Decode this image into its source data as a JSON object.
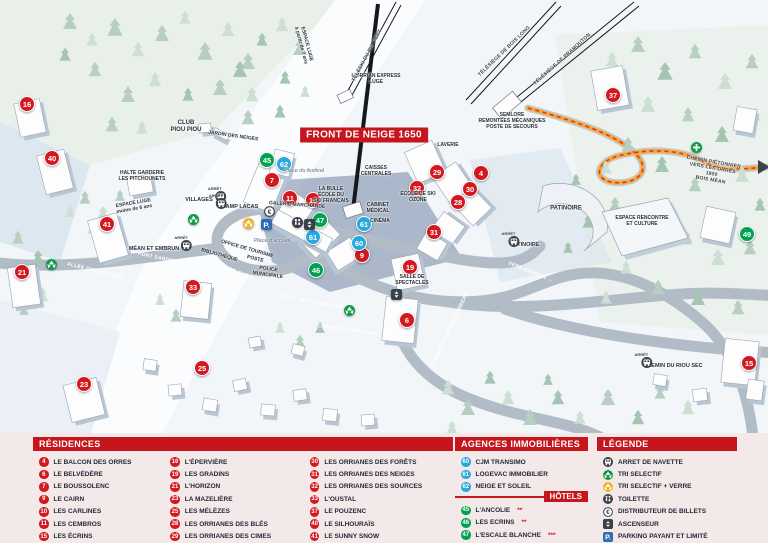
{
  "map": {
    "banner": "FRONT DE NEIGE 1650",
    "markers": [
      {
        "n": "16",
        "t": "res",
        "x": 27,
        "y": 104
      },
      {
        "n": "40",
        "t": "res",
        "x": 52,
        "y": 158
      },
      {
        "n": "41",
        "t": "res",
        "x": 107,
        "y": 224
      },
      {
        "n": "21",
        "t": "res",
        "x": 22,
        "y": 272
      },
      {
        "n": "23",
        "t": "res",
        "x": 84,
        "y": 384
      },
      {
        "n": "25",
        "t": "res",
        "x": 202,
        "y": 368
      },
      {
        "n": "33",
        "t": "res",
        "x": 193,
        "y": 287
      },
      {
        "n": "7",
        "t": "res",
        "x": 272,
        "y": 180
      },
      {
        "n": "11",
        "t": "res",
        "x": 290,
        "y": 198
      },
      {
        "n": "10",
        "t": "res",
        "x": 313,
        "y": 200
      },
      {
        "n": "9",
        "t": "res",
        "x": 362,
        "y": 255
      },
      {
        "n": "29",
        "t": "res",
        "x": 437,
        "y": 172
      },
      {
        "n": "4",
        "t": "res",
        "x": 481,
        "y": 173
      },
      {
        "n": "32",
        "t": "res",
        "x": 417,
        "y": 188
      },
      {
        "n": "30",
        "t": "res",
        "x": 470,
        "y": 189
      },
      {
        "n": "28",
        "t": "res",
        "x": 458,
        "y": 202
      },
      {
        "n": "31",
        "t": "res",
        "x": 434,
        "y": 232
      },
      {
        "n": "19",
        "t": "res",
        "x": 410,
        "y": 267
      },
      {
        "n": "6",
        "t": "res",
        "x": 407,
        "y": 320
      },
      {
        "n": "15",
        "t": "res",
        "x": 749,
        "y": 363
      },
      {
        "n": "37",
        "t": "res",
        "x": 613,
        "y": 95
      },
      {
        "n": "62",
        "t": "ag",
        "x": 284,
        "y": 164
      },
      {
        "n": "61",
        "t": "ag",
        "x": 364,
        "y": 224
      },
      {
        "n": "61",
        "t": "ag",
        "x": 313,
        "y": 237
      },
      {
        "n": "60",
        "t": "ag",
        "x": 359,
        "y": 243
      },
      {
        "n": "45",
        "t": "ho",
        "x": 267,
        "y": 160
      },
      {
        "n": "47",
        "t": "ho",
        "x": 320,
        "y": 220
      },
      {
        "n": "46",
        "t": "ho",
        "x": 316,
        "y": 270
      },
      {
        "n": "49",
        "t": "ho",
        "x": 747,
        "y": 234
      }
    ],
    "labels": [
      {
        "text": "CLUB\nPIOU PIOU",
        "x": 186,
        "y": 127,
        "cls": "fac"
      },
      {
        "text": "JARDIN DES NEIGES",
        "x": 233,
        "y": 137,
        "cls": "facsm",
        "rot": 8
      },
      {
        "text": "HALTE GARDERIE\nLES PITCHOUNETS",
        "x": 142,
        "y": 177,
        "cls": "facsm"
      },
      {
        "text": "ESPACE LUGE\nmoins de 6 ans",
        "x": 134,
        "y": 207,
        "cls": "facsm",
        "rot": -10
      },
      {
        "text": "ESPACE LUGE\nà partir de 7 ans",
        "x": 303,
        "y": 45,
        "cls": "facsm",
        "rot": 75
      },
      {
        "text": "L'ORRIAN EXPRESS\nLUGE",
        "x": 376,
        "y": 80,
        "cls": "facsm"
      },
      {
        "text": "SEMLORE\nREMONTÉES MÉCANIQUES\nPOSTE DE SECOURS",
        "x": 512,
        "y": 122,
        "cls": "facsm"
      },
      {
        "text": "LAVERIE",
        "x": 448,
        "y": 146,
        "cls": "facsm"
      },
      {
        "text": "CAISSES\nCENTRALES",
        "x": 376,
        "y": 172,
        "cls": "facsm"
      },
      {
        "text": "LA BULLE\nÉCOLE DU\nSKI FRANÇAIS",
        "x": 331,
        "y": 196,
        "cls": "facsm"
      },
      {
        "text": "Place du festival",
        "x": 304,
        "y": 171,
        "cls": "place"
      },
      {
        "text": "GALERIE MARCHANDE",
        "x": 297,
        "y": 206,
        "cls": "facsm",
        "rot": 4
      },
      {
        "text": "ÉCOLE DE SKI\nOZONE",
        "x": 418,
        "y": 198,
        "cls": "facsm"
      },
      {
        "text": "CABINET\nMÉDICAL",
        "x": 378,
        "y": 209,
        "cls": "facsm"
      },
      {
        "text": "CINÉMA",
        "x": 380,
        "y": 222,
        "cls": "facsm"
      },
      {
        "text": "OFFICE DE TOURISME",
        "x": 247,
        "y": 250,
        "cls": "facsm",
        "rot": 16
      },
      {
        "text": "BIBLIOTHÈQUE",
        "x": 219,
        "y": 256,
        "cls": "facsm",
        "rot": 16
      },
      {
        "text": "POSTE",
        "x": 255,
        "y": 260,
        "cls": "facsm",
        "rot": 14
      },
      {
        "text": "POLICE\nMUNICIPALE",
        "x": 268,
        "y": 273,
        "cls": "facsm",
        "rot": 8
      },
      {
        "text": "DÉPOSE CARS",
        "x": 233,
        "y": 272,
        "cls": "road",
        "rot": 20
      },
      {
        "text": "Place d'accueil",
        "x": 272,
        "y": 241,
        "cls": "place"
      },
      {
        "text": "PATINOIRE",
        "x": 566,
        "y": 209,
        "cls": "fac"
      },
      {
        "text": "ESPACE RENCONTRE\nET CULTURE",
        "x": 642,
        "y": 222,
        "cls": "facsm"
      },
      {
        "text": "SALLE DE\nSPECTACLES",
        "x": 412,
        "y": 281,
        "cls": "facsm"
      },
      {
        "text": "ALLÉE DES CHAMOIS",
        "x": 95,
        "y": 272,
        "cls": "road",
        "rot": 14
      },
      {
        "text": "PONT SARDINS",
        "x": 158,
        "y": 259,
        "cls": "road",
        "rot": 12
      },
      {
        "text": "ROUTE DE PRAMOUTON",
        "x": 310,
        "y": 303,
        "cls": "road",
        "rot": 10
      },
      {
        "text": "CHEMIN DU MOUFLON",
        "x": 347,
        "y": 331,
        "cls": "road",
        "rot": 8
      },
      {
        "text": "CHEMIN DU GRAND CORBEAU",
        "x": 451,
        "y": 330,
        "cls": "road",
        "rot": -65
      },
      {
        "text": "VERS EMBRUN →",
        "x": 530,
        "y": 273,
        "cls": "road",
        "rot": 22
      },
      {
        "text": "TÉLÉSKI DU PIC VERT",
        "x": 368,
        "y": 56,
        "cls": "lift",
        "rot": -62
      },
      {
        "text": "TÉLÉSIÈGE DE BOIS LONG",
        "x": 505,
        "y": 52,
        "cls": "lift",
        "rot": -44
      },
      {
        "text": "TÉLÉSIÈGE DE PRAMOUTON",
        "x": 563,
        "y": 60,
        "cls": "lift",
        "rot": -42
      },
      {
        "text": "CHEMIN PIÉTONNIER\nVERS LES ORRES 1800\nBOIS MÉAN",
        "x": 712,
        "y": 172,
        "cls": "lift",
        "rot": 10
      }
    ],
    "stops": [
      {
        "caption": "ARRÊT",
        "name": "VILLAGES",
        "x": 200,
        "y": 200,
        "side": "right"
      },
      {
        "caption": "ARRÊT",
        "name": "CHAMP LACAS",
        "x": 237,
        "y": 207,
        "side": "left"
      },
      {
        "caption": "ARRÊT",
        "name": "MÉAN ET EMBRUN",
        "x": 155,
        "y": 249,
        "side": "right"
      },
      {
        "caption": "ARRÊT",
        "name": "PATINOIRE",
        "x": 524,
        "y": 245,
        "side": "left"
      },
      {
        "caption": "ARRÊT",
        "name": "CHEMIN DU RIOU SEC",
        "x": 672,
        "y": 366,
        "side": "left"
      }
    ],
    "icons": [
      {
        "type": "recycle-green",
        "x": 46,
        "y": 268
      },
      {
        "type": "recycle-green",
        "x": 188,
        "y": 223
      },
      {
        "type": "recycle-green",
        "x": 344,
        "y": 314
      },
      {
        "type": "cross-green",
        "x": 691,
        "y": 151
      },
      {
        "type": "recycle-yellow",
        "x": 243,
        "y": 227
      },
      {
        "type": "parking",
        "x": 261,
        "y": 228
      },
      {
        "type": "euro",
        "x": 264,
        "y": 215
      },
      {
        "type": "wc",
        "x": 292,
        "y": 226
      },
      {
        "type": "elevator",
        "x": 304,
        "y": 228
      },
      {
        "type": "elevator",
        "x": 391,
        "y": 298
      }
    ]
  },
  "legend": {
    "residences": {
      "title": "RÉSIDENCES",
      "items": [
        {
          "n": "4",
          "label": "LE BALCON DES ORRES"
        },
        {
          "n": "6",
          "label": "LE BELVÉDÈRE"
        },
        {
          "n": "7",
          "label": "LE BOUSSOLENC"
        },
        {
          "n": "9",
          "label": "LE CAIRN"
        },
        {
          "n": "10",
          "label": "LES CARLINES"
        },
        {
          "n": "11",
          "label": "LES CEMBROS"
        },
        {
          "n": "15",
          "label": "LES ÉCRINS"
        },
        {
          "n": "16",
          "label": "L'ÉPERVIÈRE"
        },
        {
          "n": "19",
          "label": "LES GRADINS"
        },
        {
          "n": "21",
          "label": "L'HORIZON"
        },
        {
          "n": "23",
          "label": "LA MAZELIÈRE"
        },
        {
          "n": "25",
          "label": "LES MÉLÈZES"
        },
        {
          "n": "28",
          "label": "LES ORRIANES DES BLÉS"
        },
        {
          "n": "29",
          "label": "LES ORRIANES DES CIMES"
        },
        {
          "n": "30",
          "label": "LES ORRIANES DES FORÊTS"
        },
        {
          "n": "31",
          "label": "LES ORRIANES DES NEIGES"
        },
        {
          "n": "32",
          "label": "LES ORRIANES DES SOURCES"
        },
        {
          "n": "33",
          "label": "L'OUSTAL"
        },
        {
          "n": "37",
          "label": "LE POUZENC"
        },
        {
          "n": "40",
          "label": "LE SILHOURAÏS"
        },
        {
          "n": "41",
          "label": "LE SUNNY SNOW"
        }
      ]
    },
    "agences": {
      "title": "AGENCES IMMOBILIÈRES",
      "items": [
        {
          "n": "60",
          "label": "CJM TRANSIMO"
        },
        {
          "n": "61",
          "label": "LOGEVAC IMMOBILIER"
        },
        {
          "n": "62",
          "label": "NEIGE ET SOLEIL"
        }
      ]
    },
    "hotels": {
      "title": "HÔTELS",
      "items": [
        {
          "n": "45",
          "label": "L'ANCOLIE",
          "stars": "**"
        },
        {
          "n": "46",
          "label": "LES ECRINS",
          "stars": "**"
        },
        {
          "n": "47",
          "label": "L'ESCALE BLANCHE",
          "stars": "***"
        },
        {
          "n": "49",
          "label": "LES TRAPPEURS",
          "stars": "**"
        }
      ]
    },
    "legende": {
      "title": "LÉGENDE",
      "items": [
        {
          "type": "bus",
          "label": "ARRET DE NAVETTE"
        },
        {
          "type": "recycle-green",
          "label": "TRI SELECTIF"
        },
        {
          "type": "recycle-yellow",
          "label": "TRI SELECTIF + VERRE"
        },
        {
          "type": "wc",
          "label": "TOILETTE"
        },
        {
          "type": "euro",
          "label": "DISTRIBUTEUR DE BILLETS"
        },
        {
          "type": "elevator",
          "label": "ASCENSEUR"
        },
        {
          "type": "parking",
          "label": "PARKING PAYANT ET LIMITÉ"
        }
      ]
    }
  },
  "colors": {
    "red": "#c4161c",
    "marker_red": "#d31920",
    "marker_blue": "#29a8e0",
    "marker_green": "#00a351",
    "parking_blue": "#2e6db4",
    "path_orange": "#f3a93c",
    "road_gray": "#b2bcc6",
    "panel_pink": "#f4e9e9"
  }
}
